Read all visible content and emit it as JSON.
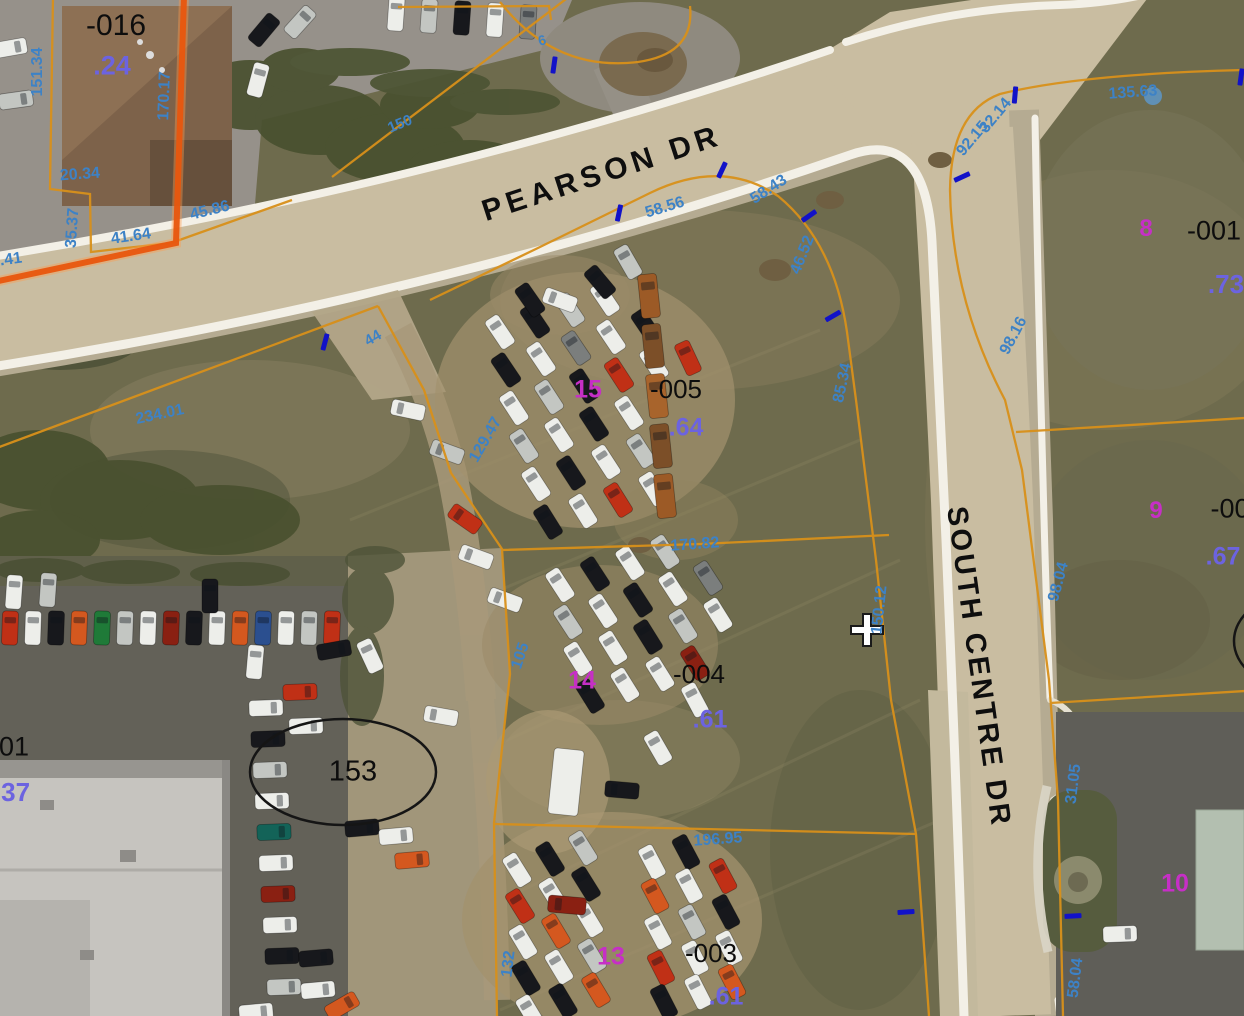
{
  "colors": {
    "parcel_line": "#d8901a",
    "boundary_thick": "#e8560e",
    "dimension_text": "#3d82c6",
    "lot_number_text": "#c62fc6",
    "acreage_text": "#6c63e0",
    "parcel_id_text": "#0d0d0d",
    "tick_mark": "#1212c8",
    "annotation": "#151515"
  },
  "streets": [
    {
      "label": "PEARSON DR",
      "x": 602,
      "y": 174,
      "rot": -18,
      "size": 30,
      "ls": 5
    },
    {
      "label": "SOUTH CENTRE DR",
      "x": 978,
      "y": 667,
      "rot": 82,
      "size": 29,
      "ls": 3
    }
  ],
  "parcel_ids": [
    {
      "text": "-016",
      "x": 116,
      "y": 26,
      "size": 30
    },
    {
      "text": "-005",
      "x": 676,
      "y": 389,
      "size": 26
    },
    {
      "text": "-004",
      "x": 699,
      "y": 674,
      "size": 26
    },
    {
      "text": "-003",
      "x": 711,
      "y": 953,
      "size": 26
    },
    {
      "text": "-001",
      "x": 1214,
      "y": 231,
      "size": 27
    },
    {
      "text": "-00",
      "x": 1230,
      "y": 509,
      "size": 27
    },
    {
      "text": "01",
      "x": 14,
      "y": 747,
      "size": 27
    },
    {
      "text": "153",
      "x": 353,
      "y": 772,
      "size": 29
    }
  ],
  "lot_numbers": [
    {
      "text": "15",
      "x": 588,
      "y": 390,
      "size": 25
    },
    {
      "text": "14",
      "x": 582,
      "y": 681,
      "size": 25
    },
    {
      "text": "13",
      "x": 611,
      "y": 957,
      "size": 25
    },
    {
      "text": "8",
      "x": 1146,
      "y": 229,
      "size": 24
    },
    {
      "text": "9",
      "x": 1156,
      "y": 511,
      "size": 24
    },
    {
      "text": "10",
      "x": 1175,
      "y": 884,
      "size": 25
    }
  ],
  "acreage_values": [
    {
      "text": ".24",
      "x": 112,
      "y": 66,
      "size": 27
    },
    {
      "text": ".64",
      "x": 686,
      "y": 428,
      "size": 25
    },
    {
      "text": ".61",
      "x": 710,
      "y": 720,
      "size": 25
    },
    {
      "text": ".61",
      "x": 726,
      "y": 997,
      "size": 25
    },
    {
      "text": ".73",
      "x": 1226,
      "y": 284,
      "size": 26
    },
    {
      "text": ".67",
      "x": 1223,
      "y": 557,
      "size": 25
    },
    {
      "text": ".37",
      "x": 12,
      "y": 792,
      "size": 26
    }
  ],
  "dimensions": [
    {
      "text": "151.34",
      "x": 38,
      "y": 72,
      "rot": -90
    },
    {
      "text": "170.17",
      "x": 165,
      "y": 96,
      "rot": -88
    },
    {
      "text": "20.34",
      "x": 80,
      "y": 175,
      "rot": -4
    },
    {
      "text": "45.86",
      "x": 210,
      "y": 211,
      "rot": -14
    },
    {
      "text": "41.64",
      "x": 131,
      "y": 237,
      "rot": -8
    },
    {
      "text": "35.37",
      "x": 73,
      "y": 228,
      "rot": -86
    },
    {
      "text": ".41",
      "x": 11,
      "y": 260,
      "rot": -8
    },
    {
      "text": "234.01",
      "x": 160,
      "y": 415,
      "rot": -12
    },
    {
      "text": "44",
      "x": 373,
      "y": 338,
      "rot": -30,
      "size": 15
    },
    {
      "text": "150",
      "x": 400,
      "y": 124,
      "rot": -22,
      "size": 15
    },
    {
      "text": "6",
      "x": 542,
      "y": 40,
      "rot": -15,
      "size": 14
    },
    {
      "text": "58.56",
      "x": 665,
      "y": 208,
      "rot": -17
    },
    {
      "text": "58.43",
      "x": 769,
      "y": 190,
      "rot": -33
    },
    {
      "text": "46.52",
      "x": 803,
      "y": 255,
      "rot": -68
    },
    {
      "text": "85.34",
      "x": 843,
      "y": 383,
      "rot": -78
    },
    {
      "text": "129.47",
      "x": 486,
      "y": 440,
      "rot": -60
    },
    {
      "text": "170.82",
      "x": 695,
      "y": 545,
      "rot": -4
    },
    {
      "text": "150.12",
      "x": 880,
      "y": 610,
      "rot": -84
    },
    {
      "text": "105",
      "x": 521,
      "y": 656,
      "rot": -72
    },
    {
      "text": "132",
      "x": 509,
      "y": 964,
      "rot": -83
    },
    {
      "text": "196.95",
      "x": 718,
      "y": 840,
      "rot": -4
    },
    {
      "text": "135.63",
      "x": 1133,
      "y": 93,
      "rot": -4
    },
    {
      "text": "32.14",
      "x": 996,
      "y": 116,
      "rot": -50
    },
    {
      "text": "92.15",
      "x": 973,
      "y": 139,
      "rot": -50
    },
    {
      "text": "98.16",
      "x": 1014,
      "y": 336,
      "rot": -62
    },
    {
      "text": "98.04",
      "x": 1059,
      "y": 582,
      "rot": -75
    },
    {
      "text": "31.05",
      "x": 1074,
      "y": 784,
      "rot": -83
    },
    {
      "text": "58.04",
      "x": 1076,
      "y": 978,
      "rot": -83
    }
  ],
  "tick_marks": [
    {
      "x": 325,
      "y": 342,
      "rot": 15
    },
    {
      "x": 554,
      "y": 65,
      "rot": 8
    },
    {
      "x": 619,
      "y": 213,
      "rot": 12
    },
    {
      "x": 722,
      "y": 170,
      "rot": 25
    },
    {
      "x": 809,
      "y": 216,
      "rot": 55
    },
    {
      "x": 833,
      "y": 316,
      "rot": 60
    },
    {
      "x": 1015,
      "y": 95,
      "rot": 5
    },
    {
      "x": 962,
      "y": 177,
      "rot": 65
    },
    {
      "x": 1241,
      "y": 77,
      "rot": 8
    },
    {
      "x": 1073,
      "y": 916,
      "rot": 87
    },
    {
      "x": 906,
      "y": 912,
      "rot": 86
    }
  ],
  "crosshair": {
    "x": 867,
    "y": 630
  },
  "ellipse_annotations": [
    {
      "cx": 343,
      "cy": 772,
      "rx": 93,
      "ry": 53
    },
    {
      "cx": 1296,
      "cy": 641,
      "rx": 62,
      "ry": 47
    }
  ]
}
